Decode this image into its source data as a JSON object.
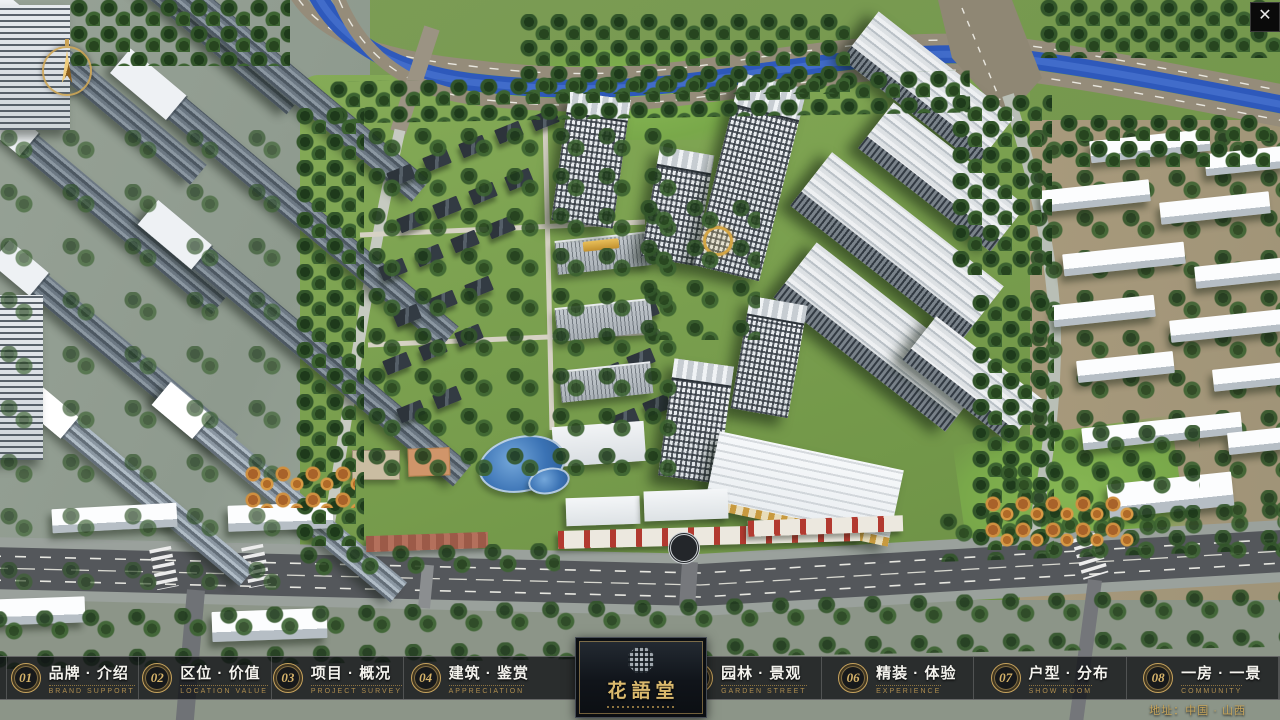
{
  "app": {
    "close_glyph": "✕"
  },
  "nav": {
    "items": [
      {
        "num": "01",
        "label": "品牌 · 介绍",
        "caption": "BRAND SUPPORT"
      },
      {
        "num": "02",
        "label": "区位 · 价值",
        "caption": "LOCATION VALUE"
      },
      {
        "num": "03",
        "label": "项目 · 概况",
        "caption": "PROJECT SURVEY"
      },
      {
        "num": "04",
        "label": "建筑 · 鉴赏",
        "caption": "APPRECIATION"
      },
      {
        "num": "05",
        "label": "园林 · 景观",
        "caption": "GARDEN STREET"
      },
      {
        "num": "06",
        "label": "精装 · 体验",
        "caption": "EXPERIENCE"
      },
      {
        "num": "07",
        "label": "户型 · 分布",
        "caption": "SHOW ROOM"
      },
      {
        "num": "08",
        "label": "一房 · 一景",
        "caption": "COMMUNITY"
      }
    ]
  },
  "logo": {
    "title": "花語堂"
  },
  "footer": {
    "address": "地址：中国 · 山西"
  },
  "colors": {
    "gold_accent": "#d0ad62",
    "nav_background": "rgba(14,16,19,0.78)",
    "river_blue": "#2e59bb",
    "community_green": "#74994a",
    "road_asphalt": "#54575b"
  }
}
